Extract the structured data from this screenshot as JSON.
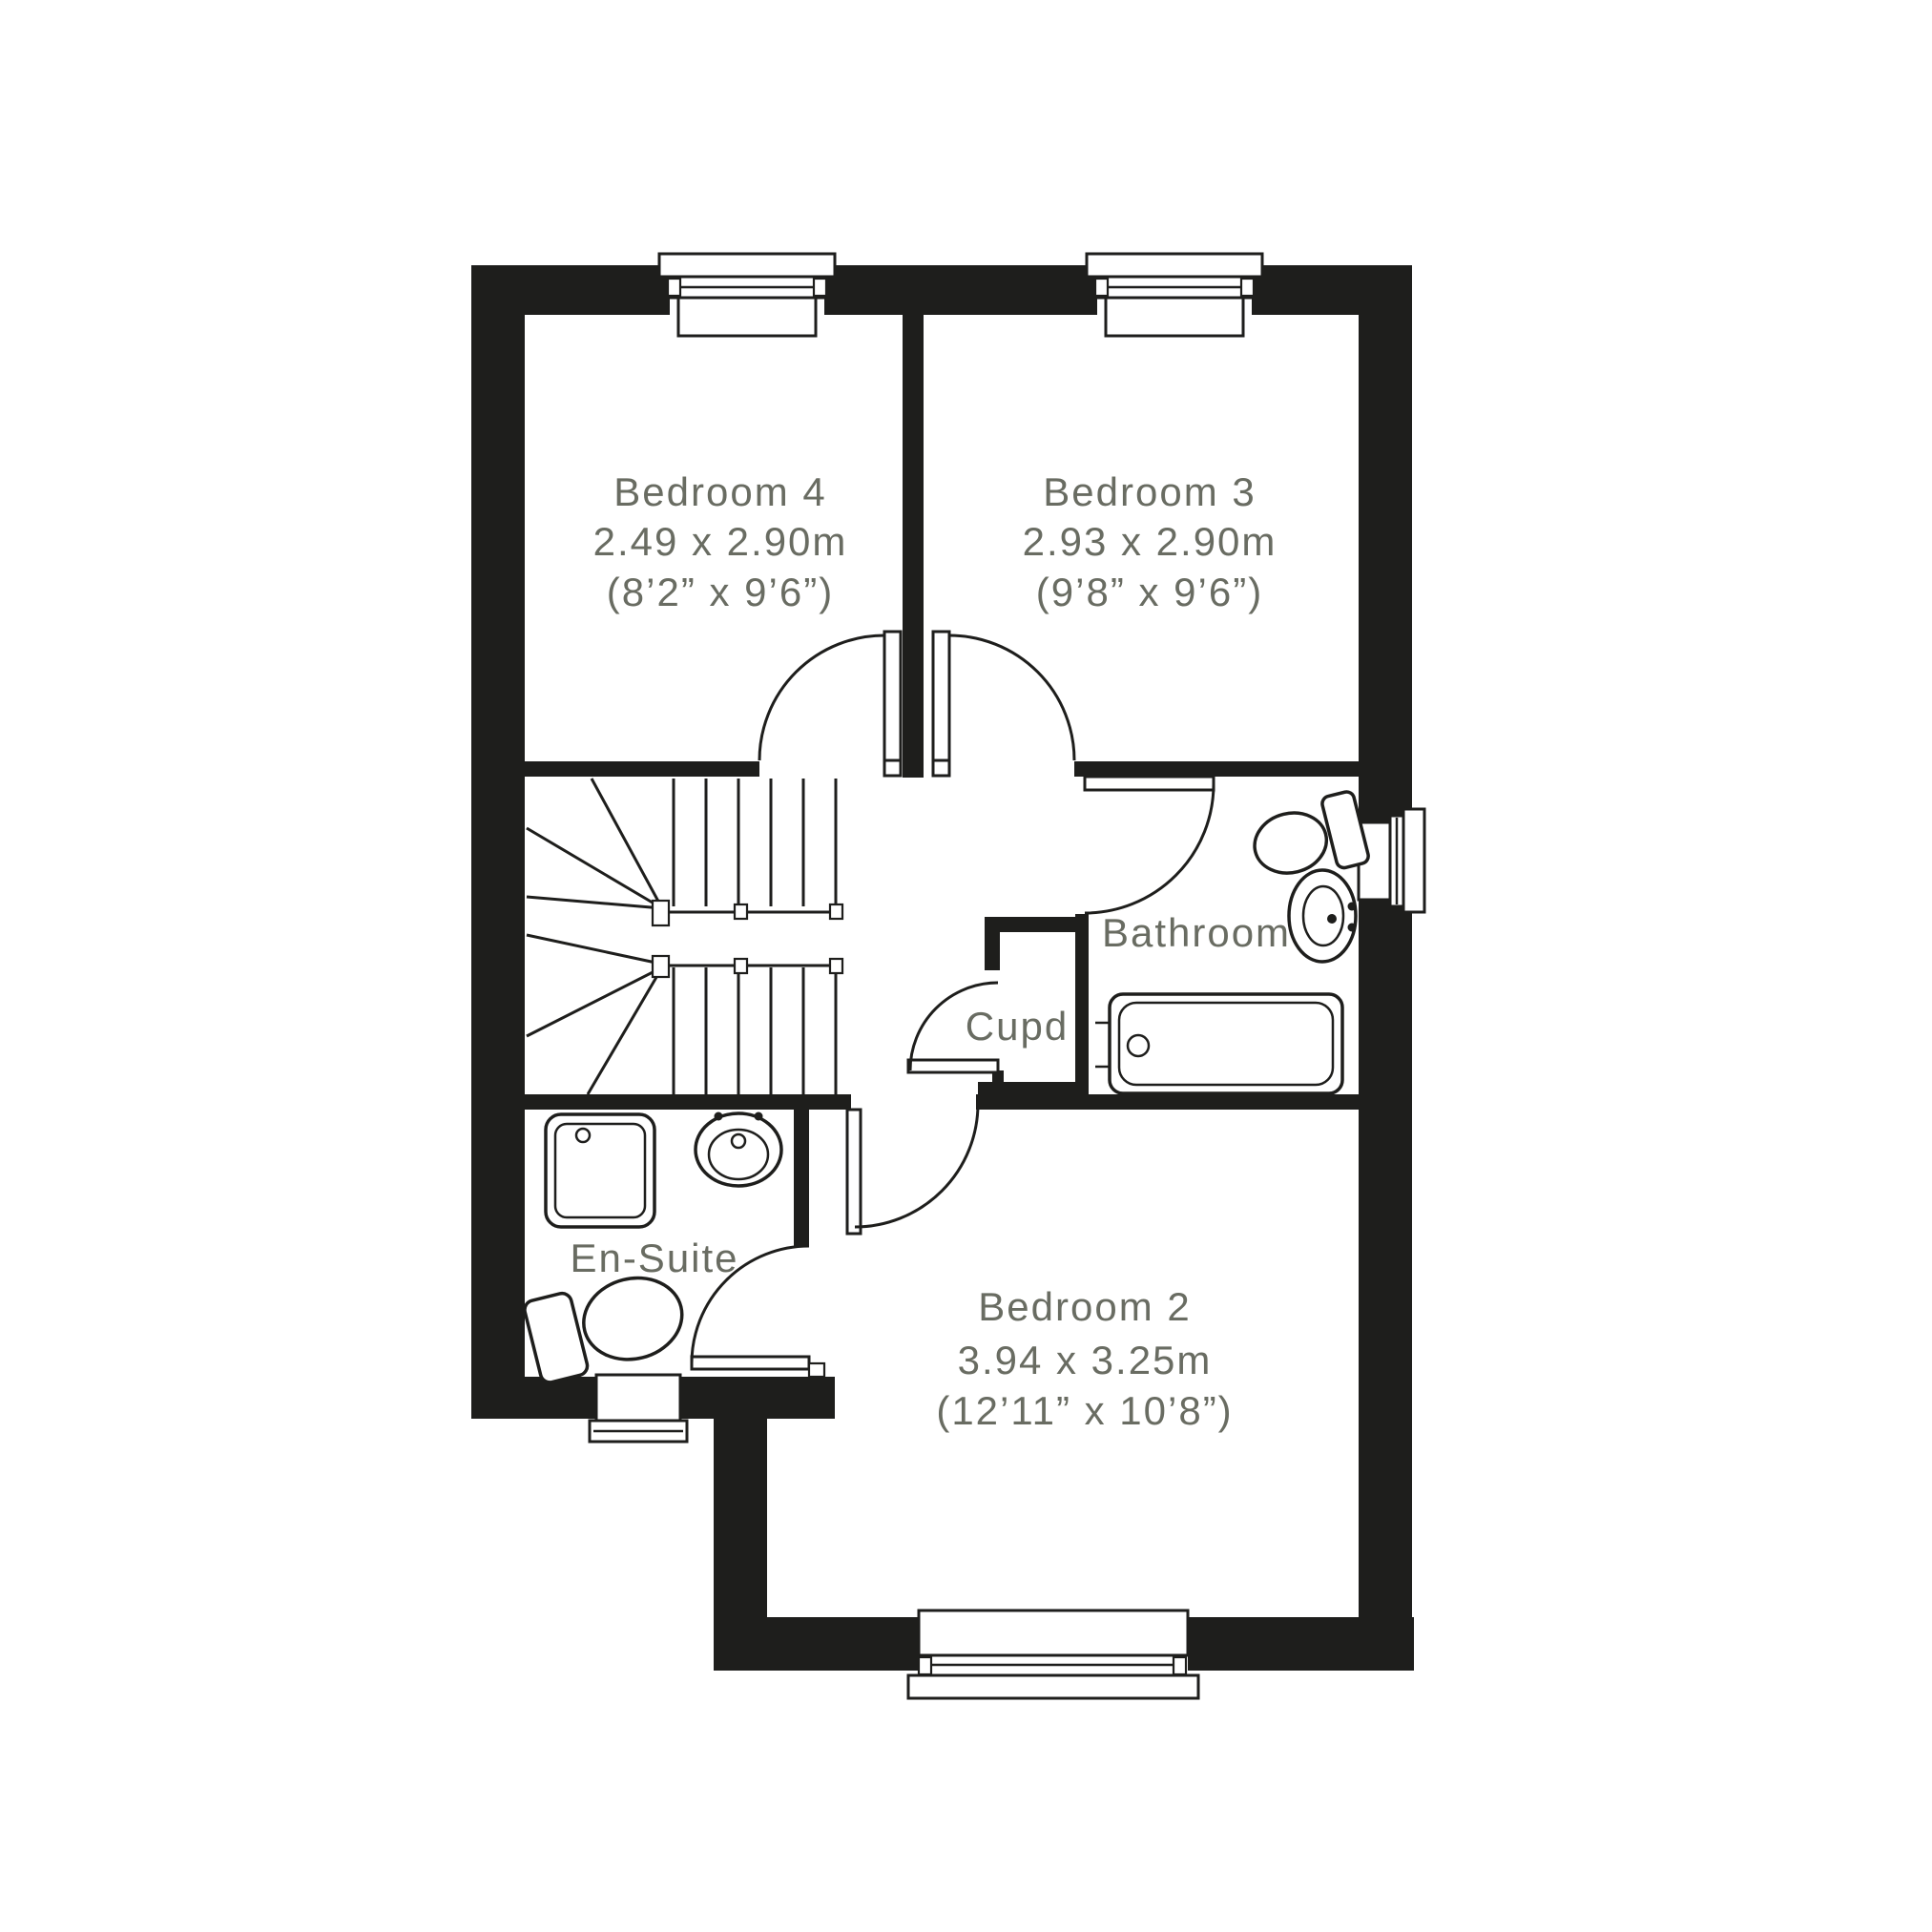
{
  "colors": {
    "wall": "#1e1e1c",
    "text": "#696c62",
    "background": "#ffffff"
  },
  "rooms": {
    "bedroom4": {
      "name": "Bedroom 4",
      "size_metric": "2.49 x 2.90m",
      "size_imperial": "(8’2” x 9’6”)"
    },
    "bedroom3": {
      "name": "Bedroom 3",
      "size_metric": "2.93 x 2.90m",
      "size_imperial": "(9’8” x 9’6”)"
    },
    "bedroom2": {
      "name": "Bedroom 2",
      "size_metric": "3.94 x 3.25m",
      "size_imperial": "(12’11” x 10’8”)"
    },
    "bathroom": {
      "name": "Bathroom"
    },
    "ensuite": {
      "name": "En-Suite"
    },
    "cupboard": {
      "name": "Cupd"
    }
  },
  "fixtures": [
    "staircase",
    "bathtub",
    "toilet",
    "wash-basin",
    "shower-tray"
  ]
}
